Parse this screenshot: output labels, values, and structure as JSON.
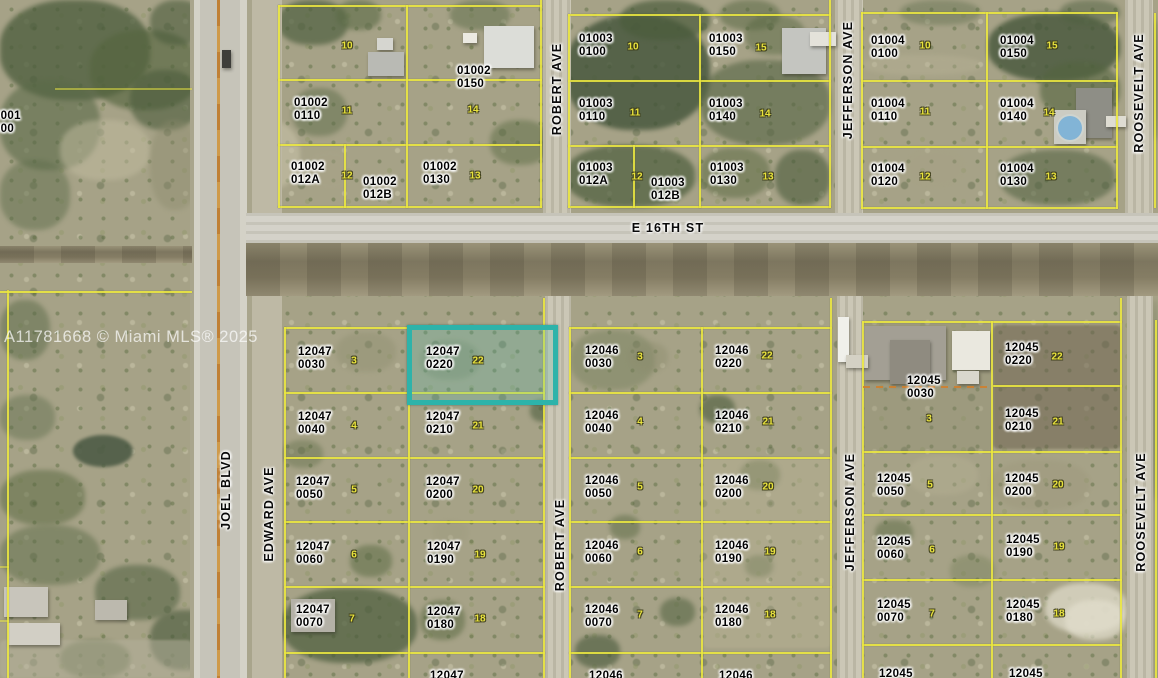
{
  "map": {
    "watermark": "A11781668 © Miami MLS® 2025",
    "colors": {
      "parcel_line": "#ece83f",
      "highlight": "#2db3aa",
      "lot_number": "#e9e33c",
      "label_text": "#000000",
      "road": "#cbc7b6",
      "pool": "#82b4d6"
    },
    "highlighted_parcel": {
      "id": "12047 0220",
      "lot": "22"
    },
    "street_labels": [
      {
        "label": "E 16TH ST",
        "x": 668,
        "y": 228,
        "rot": 0
      },
      {
        "label": "ROBERT AVE",
        "x": 557,
        "y": 89,
        "rot": -90
      },
      {
        "label": "ROBERT AVE",
        "x": 560,
        "y": 545,
        "rot": -90
      },
      {
        "label": "JEFFERSON AVE",
        "x": 848,
        "y": 80,
        "rot": -90
      },
      {
        "label": "JEFFERSON AVE",
        "x": 850,
        "y": 512,
        "rot": -90
      },
      {
        "label": "ROOSEVELT AVE",
        "x": 1139,
        "y": 93,
        "rot": -90
      },
      {
        "label": "ROOSEVELT AVE",
        "x": 1141,
        "y": 512,
        "rot": -90
      },
      {
        "label": "JOEL BLVD",
        "x": 226,
        "y": 490,
        "rot": -90
      },
      {
        "label": "EDWARD AVE",
        "x": 269,
        "y": 514,
        "rot": -90
      }
    ],
    "parcel_labels": [
      {
        "l1": "00001",
        "l2": "0000",
        "x": -13,
        "y": 110
      },
      {
        "l1": "01002",
        "l2": "0110",
        "x": 294,
        "y": 97
      },
      {
        "l1": "01002",
        "l2": "0150",
        "x": 457,
        "y": 65
      },
      {
        "l1": "01002",
        "l2": "012A",
        "x": 291,
        "y": 161
      },
      {
        "l1": "01002",
        "l2": "012B",
        "x": 363,
        "y": 176
      },
      {
        "l1": "01002",
        "l2": "0130",
        "x": 423,
        "y": 161
      },
      {
        "l1": "01003",
        "l2": "0100",
        "x": 579,
        "y": 33
      },
      {
        "l1": "01003",
        "l2": "0150",
        "x": 709,
        "y": 33
      },
      {
        "l1": "01003",
        "l2": "0110",
        "x": 579,
        "y": 98
      },
      {
        "l1": "01003",
        "l2": "0140",
        "x": 709,
        "y": 98
      },
      {
        "l1": "01003",
        "l2": "012A",
        "x": 579,
        "y": 162
      },
      {
        "l1": "01003",
        "l2": "012B",
        "x": 651,
        "y": 177
      },
      {
        "l1": "01003",
        "l2": "0130",
        "x": 710,
        "y": 162
      },
      {
        "l1": "01004",
        "l2": "0100",
        "x": 871,
        "y": 35
      },
      {
        "l1": "01004",
        "l2": "0150",
        "x": 1000,
        "y": 35
      },
      {
        "l1": "01004",
        "l2": "0110",
        "x": 871,
        "y": 98
      },
      {
        "l1": "01004",
        "l2": "0140",
        "x": 1000,
        "y": 98
      },
      {
        "l1": "01004",
        "l2": "0120",
        "x": 871,
        "y": 163
      },
      {
        "l1": "01004",
        "l2": "0130",
        "x": 1000,
        "y": 163
      },
      {
        "l1": "12047",
        "l2": "0030",
        "x": 298,
        "y": 346
      },
      {
        "l1": "12047",
        "l2": "0220",
        "x": 426,
        "y": 346,
        "hl": true
      },
      {
        "l1": "12047",
        "l2": "0040",
        "x": 298,
        "y": 411
      },
      {
        "l1": "12047",
        "l2": "0210",
        "x": 426,
        "y": 411
      },
      {
        "l1": "12047",
        "l2": "0050",
        "x": 296,
        "y": 476
      },
      {
        "l1": "12047",
        "l2": "0200",
        "x": 426,
        "y": 476
      },
      {
        "l1": "12047",
        "l2": "0060",
        "x": 296,
        "y": 541
      },
      {
        "l1": "12047",
        "l2": "0190",
        "x": 427,
        "y": 541
      },
      {
        "l1": "12047",
        "l2": "0070",
        "x": 296,
        "y": 604
      },
      {
        "l1": "12047",
        "l2": "0180",
        "x": 427,
        "y": 606
      },
      {
        "l1": "12047",
        "l2": "",
        "x": 430,
        "y": 670
      },
      {
        "l1": "12046",
        "l2": "0030",
        "x": 585,
        "y": 345
      },
      {
        "l1": "12046",
        "l2": "0220",
        "x": 715,
        "y": 345
      },
      {
        "l1": "12046",
        "l2": "0040",
        "x": 585,
        "y": 410
      },
      {
        "l1": "12046",
        "l2": "0210",
        "x": 715,
        "y": 410
      },
      {
        "l1": "12046",
        "l2": "0050",
        "x": 585,
        "y": 475
      },
      {
        "l1": "12046",
        "l2": "0200",
        "x": 715,
        "y": 475
      },
      {
        "l1": "12046",
        "l2": "0060",
        "x": 585,
        "y": 540
      },
      {
        "l1": "12046",
        "l2": "0190",
        "x": 715,
        "y": 540
      },
      {
        "l1": "12046",
        "l2": "0070",
        "x": 585,
        "y": 604
      },
      {
        "l1": "12046",
        "l2": "0180",
        "x": 715,
        "y": 604
      },
      {
        "l1": "12046",
        "l2": "",
        "x": 589,
        "y": 670
      },
      {
        "l1": "12046",
        "l2": "",
        "x": 719,
        "y": 670
      },
      {
        "l1": "12045",
        "l2": "0030",
        "x": 907,
        "y": 375
      },
      {
        "l1": "12045",
        "l2": "0220",
        "x": 1005,
        "y": 342
      },
      {
        "l1": "12045",
        "l2": "0210",
        "x": 1005,
        "y": 408
      },
      {
        "l1": "12045",
        "l2": "0050",
        "x": 877,
        "y": 473
      },
      {
        "l1": "12045",
        "l2": "0200",
        "x": 1005,
        "y": 473
      },
      {
        "l1": "12045",
        "l2": "0060",
        "x": 877,
        "y": 536
      },
      {
        "l1": "12045",
        "l2": "0190",
        "x": 1006,
        "y": 534
      },
      {
        "l1": "12045",
        "l2": "0070",
        "x": 877,
        "y": 599
      },
      {
        "l1": "12045",
        "l2": "0180",
        "x": 1006,
        "y": 599
      },
      {
        "l1": "12045",
        "l2": "",
        "x": 879,
        "y": 668
      },
      {
        "l1": "12045",
        "l2": "",
        "x": 1009,
        "y": 668
      }
    ],
    "lot_numbers": [
      {
        "n": "10",
        "x": 347,
        "y": 46
      },
      {
        "n": "14",
        "x": 473,
        "y": 110
      },
      {
        "n": "11",
        "x": 347,
        "y": 111
      },
      {
        "n": "12",
        "x": 347,
        "y": 176
      },
      {
        "n": "13",
        "x": 475,
        "y": 176
      },
      {
        "n": "10",
        "x": 633,
        "y": 47
      },
      {
        "n": "15",
        "x": 761,
        "y": 48
      },
      {
        "n": "11",
        "x": 635,
        "y": 113
      },
      {
        "n": "14",
        "x": 765,
        "y": 114
      },
      {
        "n": "12",
        "x": 637,
        "y": 177
      },
      {
        "n": "13",
        "x": 768,
        "y": 177
      },
      {
        "n": "10",
        "x": 925,
        "y": 46
      },
      {
        "n": "15",
        "x": 1052,
        "y": 46
      },
      {
        "n": "11",
        "x": 925,
        "y": 112
      },
      {
        "n": "14",
        "x": 1049,
        "y": 113
      },
      {
        "n": "12",
        "x": 925,
        "y": 177
      },
      {
        "n": "13",
        "x": 1051,
        "y": 177
      },
      {
        "n": "3",
        "x": 354,
        "y": 361
      },
      {
        "n": "22",
        "x": 478,
        "y": 361
      },
      {
        "n": "4",
        "x": 354,
        "y": 426
      },
      {
        "n": "21",
        "x": 478,
        "y": 426
      },
      {
        "n": "5",
        "x": 354,
        "y": 490
      },
      {
        "n": "20",
        "x": 478,
        "y": 490
      },
      {
        "n": "6",
        "x": 354,
        "y": 555
      },
      {
        "n": "19",
        "x": 480,
        "y": 555
      },
      {
        "n": "7",
        "x": 352,
        "y": 619
      },
      {
        "n": "18",
        "x": 480,
        "y": 619
      },
      {
        "n": "3",
        "x": 640,
        "y": 357
      },
      {
        "n": "22",
        "x": 767,
        "y": 356
      },
      {
        "n": "4",
        "x": 640,
        "y": 422
      },
      {
        "n": "21",
        "x": 768,
        "y": 422
      },
      {
        "n": "5",
        "x": 640,
        "y": 487
      },
      {
        "n": "20",
        "x": 768,
        "y": 487
      },
      {
        "n": "6",
        "x": 640,
        "y": 552
      },
      {
        "n": "19",
        "x": 770,
        "y": 552
      },
      {
        "n": "7",
        "x": 640,
        "y": 615
      },
      {
        "n": "18",
        "x": 770,
        "y": 615
      },
      {
        "n": "3",
        "x": 929,
        "y": 419
      },
      {
        "n": "22",
        "x": 1057,
        "y": 357
      },
      {
        "n": "21",
        "x": 1058,
        "y": 422
      },
      {
        "n": "5",
        "x": 930,
        "y": 485
      },
      {
        "n": "20",
        "x": 1058,
        "y": 485
      },
      {
        "n": "6",
        "x": 932,
        "y": 550
      },
      {
        "n": "19",
        "x": 1059,
        "y": 547
      },
      {
        "n": "7",
        "x": 932,
        "y": 614
      },
      {
        "n": "18",
        "x": 1059,
        "y": 614
      }
    ]
  }
}
